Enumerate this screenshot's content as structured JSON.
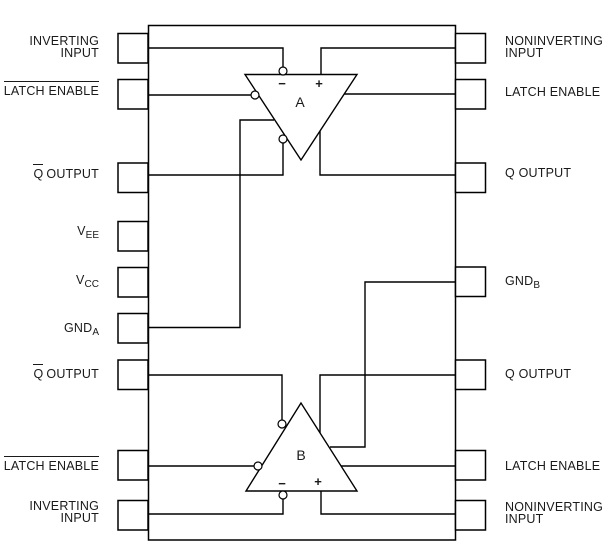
{
  "theme": {
    "ink": "#1a1a1a",
    "line": "#000000",
    "background": "#ffffff"
  },
  "comparators": [
    {
      "name": "A",
      "minus_label": "−",
      "plus_label": "+"
    },
    {
      "name": "B",
      "minus_label": "−",
      "plus_label": "+"
    }
  ],
  "pins": {
    "left": [
      {
        "id": "inverting-input-a",
        "lines": [
          "INVERTING",
          "INPUT"
        ]
      },
      {
        "id": "latch-enable-a",
        "text": "LATCH ENABLE",
        "overline": true
      },
      {
        "id": "qbar-output-a",
        "ov": "Q",
        "rest": "OUTPUT"
      },
      {
        "id": "vee",
        "base": "V",
        "sub": "EE"
      },
      {
        "id": "vcc",
        "base": "V",
        "sub": "CC"
      },
      {
        "id": "gnd-a",
        "base": "GND",
        "sub": "A"
      },
      {
        "id": "qbar-output-b",
        "ov": "Q",
        "rest": "OUTPUT"
      },
      {
        "id": "latch-enable-b",
        "text": "LATCH ENABLE",
        "overline": true
      },
      {
        "id": "inverting-input-b",
        "lines": [
          "INVERTING",
          "INPUT"
        ]
      }
    ],
    "right": [
      {
        "id": "noninverting-input-a",
        "lines": [
          "NONINVERTING",
          "INPUT"
        ]
      },
      {
        "id": "latch-enable-a",
        "text": "LATCH ENABLE",
        "overline": false
      },
      {
        "id": "q-output-a",
        "text": "Q OUTPUT"
      },
      {
        "id": "gnd-b",
        "base": "GND",
        "sub": "B"
      },
      {
        "id": "q-output-b",
        "text": "Q OUTPUT"
      },
      {
        "id": "latch-enable-b",
        "text": "LATCH ENABLE",
        "overline": false
      },
      {
        "id": "noninverting-input-b",
        "lines": [
          "NONINVERTING",
          "INPUT"
        ]
      }
    ]
  }
}
